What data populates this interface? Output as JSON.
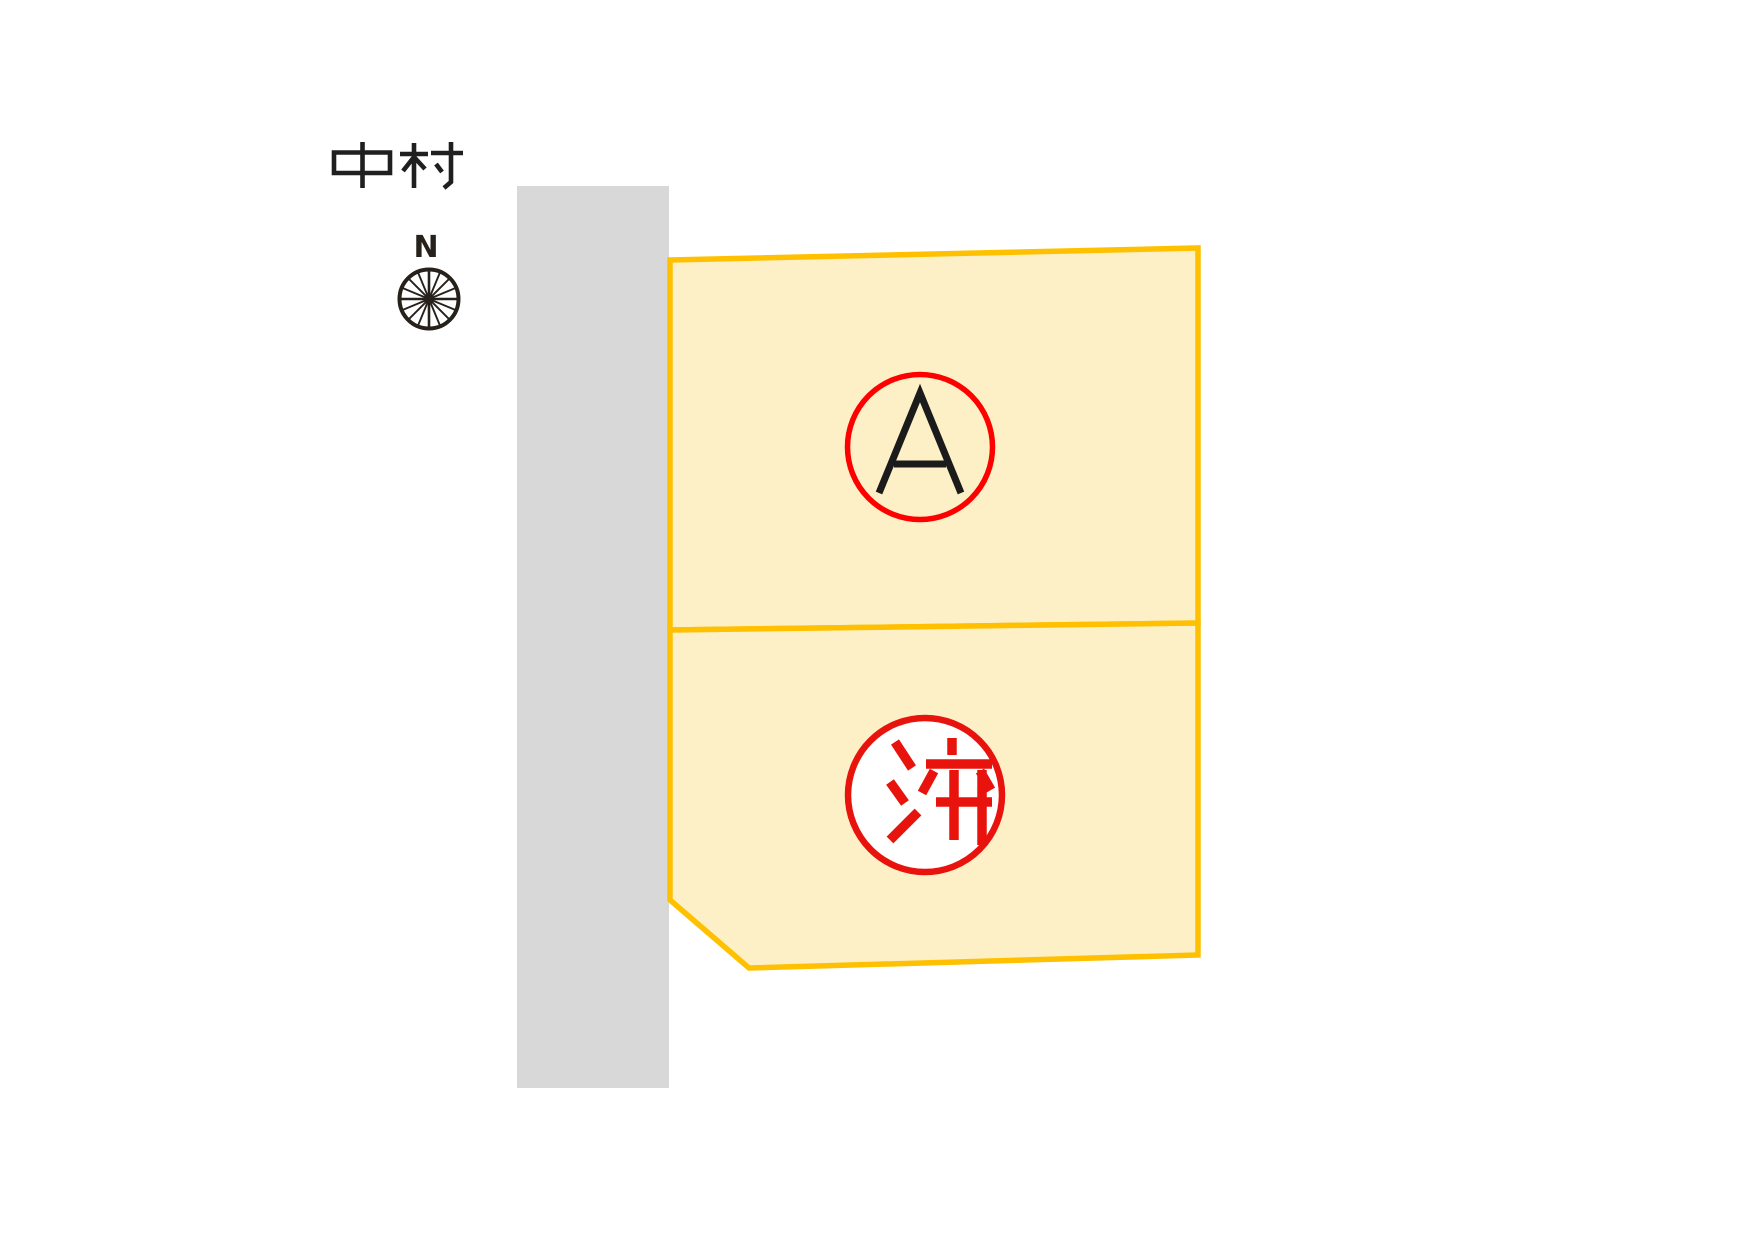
{
  "map": {
    "area_label": "中村",
    "area_text_color": "#1f1f1f",
    "compass": {
      "label": "N",
      "color": "#27211b"
    },
    "road": {
      "fill": "#d8d8d8"
    },
    "lot_style": {
      "fill": "#fdf0c7",
      "border": "#ffc000"
    },
    "lots": [
      {
        "id": "A",
        "marker": "A",
        "status": "available",
        "ring_color": "#fe0000",
        "ring_fill": "none",
        "text_color": "#1b1b1b"
      },
      {
        "id": "sold",
        "marker": "済",
        "status": "sold",
        "ring_color": "#e8130c",
        "ring_fill": "#ffffff",
        "text_color": "#e8130c"
      }
    ]
  }
}
